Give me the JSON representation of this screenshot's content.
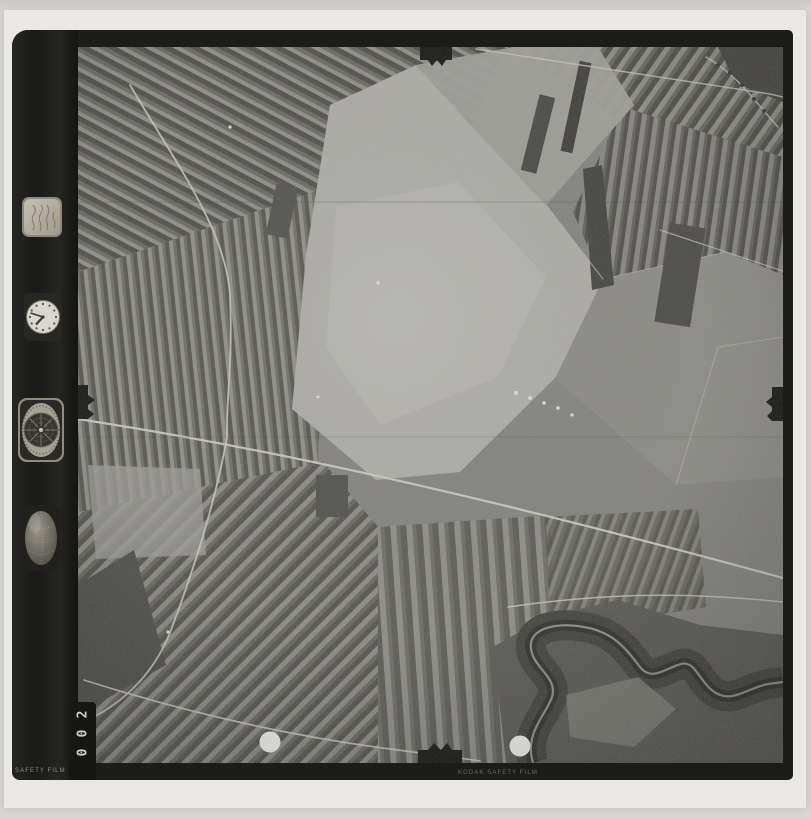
{
  "film_frame": {
    "frame_counter": {
      "value": "002",
      "digits_top_to_bottom": [
        "2",
        "0",
        "0"
      ]
    },
    "edge_markings": {
      "bottom_left": "SAFETY FILM",
      "bottom_center": "KODAK SAFETY FILM"
    }
  },
  "instrument_panel": {
    "items": [
      {
        "icon": "data-card-icon"
      },
      {
        "icon": "clock-icon"
      },
      {
        "icon": "altimeter-icon"
      },
      {
        "icon": "level-ball-icon"
      }
    ]
  },
  "photo_features": {
    "terrain": "strip-fields-farmland",
    "river": "meandering-river-bottom-right",
    "control_dots": 2,
    "fiducial_notches": 4
  },
  "colors": {
    "page_background": "#d7d6d3",
    "paper_border": "#e9e8e5",
    "film_black": "#1c1c1a",
    "photo_base_gray": "#83827e",
    "bright_field": "#acaba6",
    "river_dark": "#32322e",
    "road_light": "#c8c7c1",
    "marker_dot_white": "#eeede9"
  }
}
